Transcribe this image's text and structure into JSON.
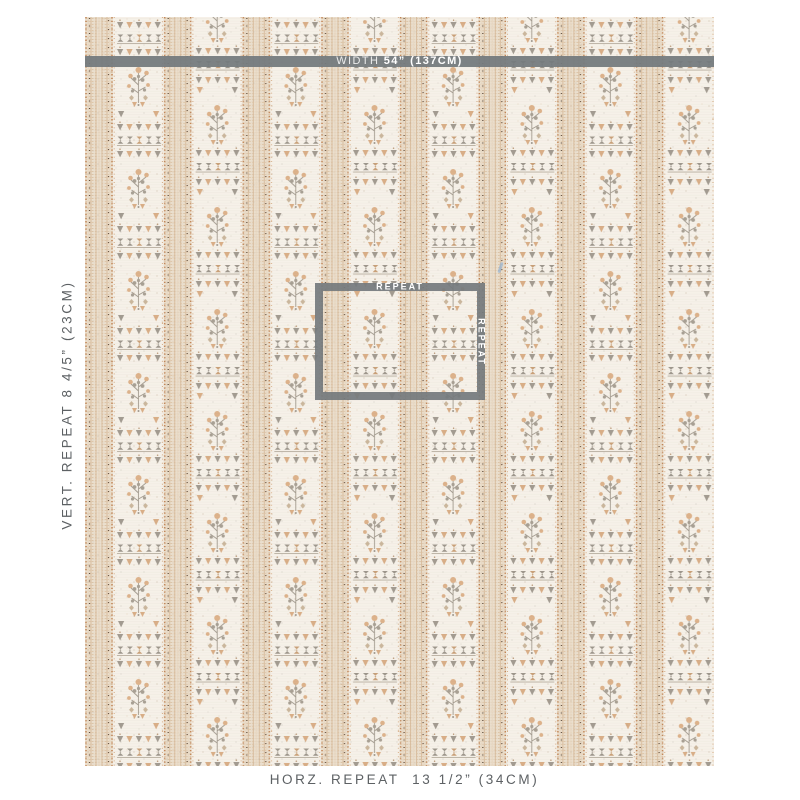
{
  "fabric_panel": {
    "width_bar": {
      "prefix": "WIDTH ",
      "value": "54” (137CM)"
    },
    "repeat_box": {
      "top_label": "REPEAT",
      "side_label": "REPEAT"
    }
  },
  "labels": {
    "vertical_repeat": "VERT. REPEAT 8 4/5” (23CM)",
    "horizontal_repeat": "HORZ. REPEAT  13 1/2” (34CM)"
  },
  "colors": {
    "overlay_gray": "#747a7d",
    "label_gray": "#5d6164",
    "fabric_cream": "#f4efe7",
    "fabric_beige": "#ebdfce",
    "motif_peach": "#d9ae87",
    "motif_gray": "#a29b91",
    "dot_orange": "#c08050",
    "dot_brown": "#5f4e3e",
    "thread_blue": "#8fb0d4"
  }
}
